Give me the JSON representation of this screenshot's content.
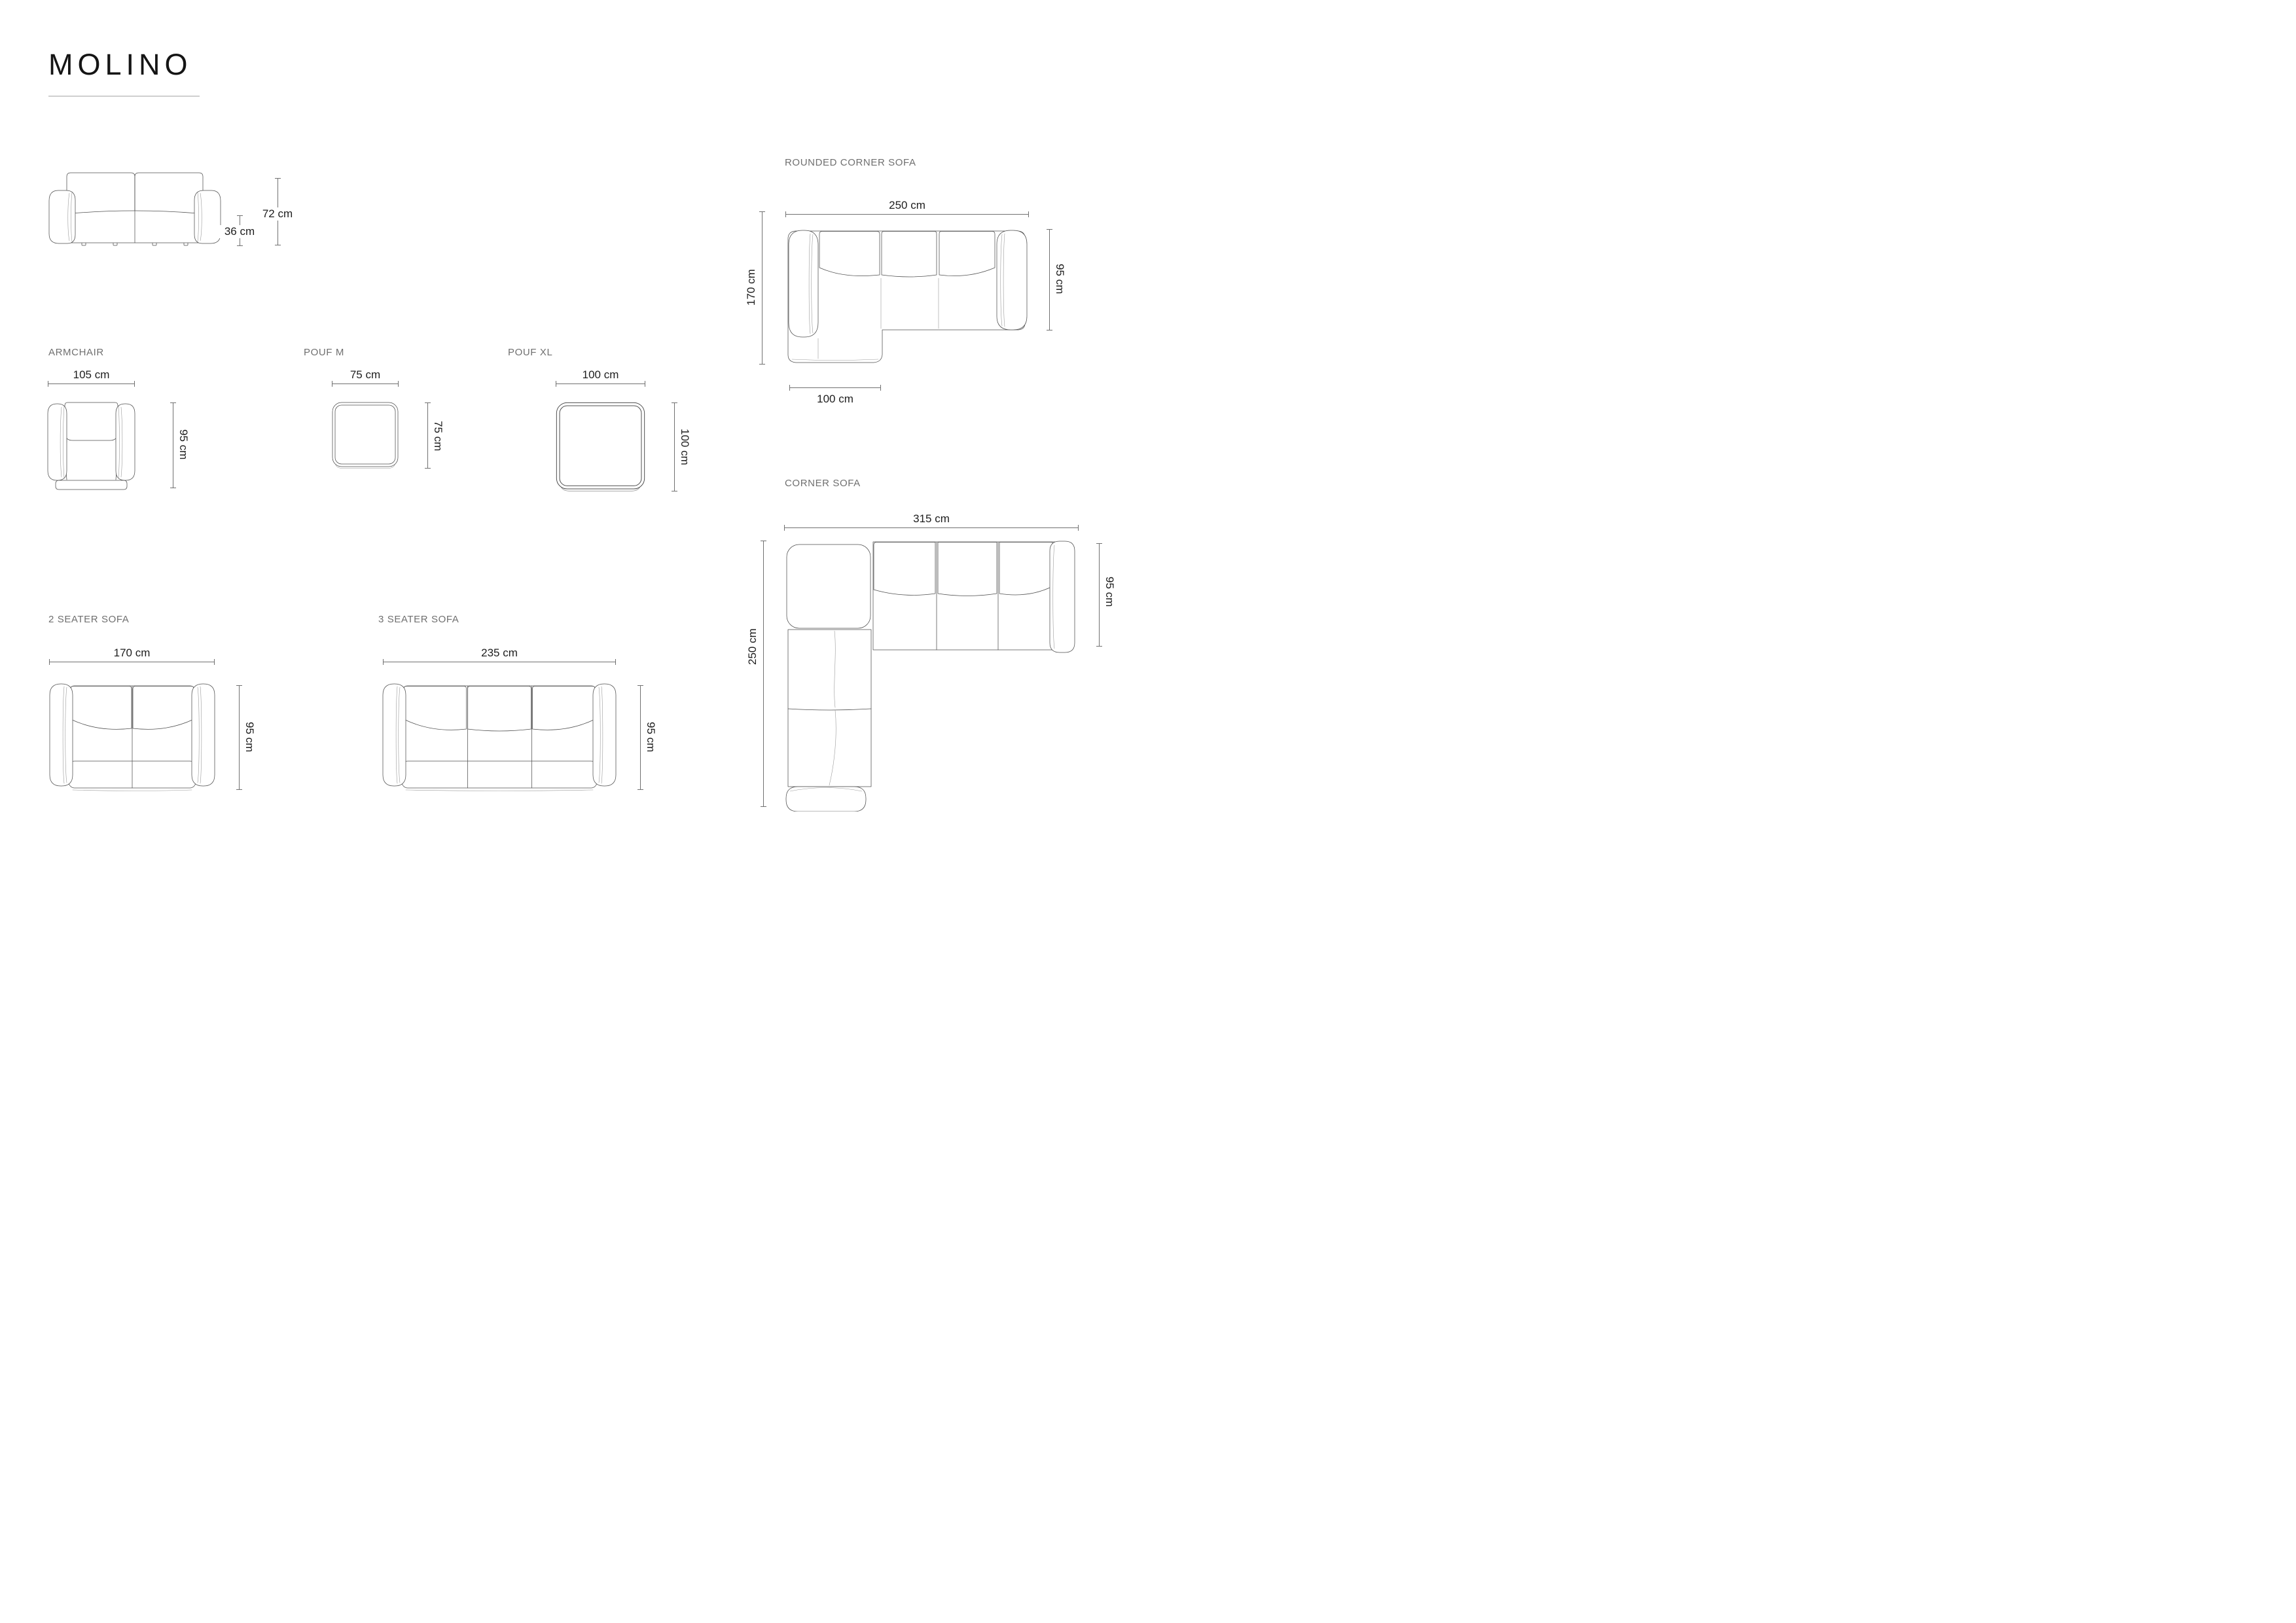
{
  "title": "MOLINO",
  "front_view": {
    "total_height": "72 cm",
    "seat_height": "36 cm"
  },
  "rounded_corner": {
    "label": "ROUNDED CORNER SOFA",
    "width": "250 cm",
    "depth": "95 cm",
    "side": "170 cm",
    "chaise_width": "100 cm"
  },
  "armchair": {
    "label": "ARMCHAIR",
    "width": "105 cm",
    "depth": "95 cm"
  },
  "pouf_m": {
    "label": "POUF M",
    "width": "75 cm",
    "depth": "75 cm"
  },
  "pouf_xl": {
    "label": "POUF XL",
    "width": "100 cm",
    "depth": "100 cm"
  },
  "seater2": {
    "label": "2 SEATER SOFA",
    "width": "170 cm",
    "depth": "95 cm"
  },
  "seater3": {
    "label": "3 SEATER SOFA",
    "width": "235 cm",
    "depth": "95 cm"
  },
  "corner": {
    "label": "CORNER SOFA",
    "width": "315 cm",
    "depth": "95 cm",
    "side": "250 cm"
  }
}
